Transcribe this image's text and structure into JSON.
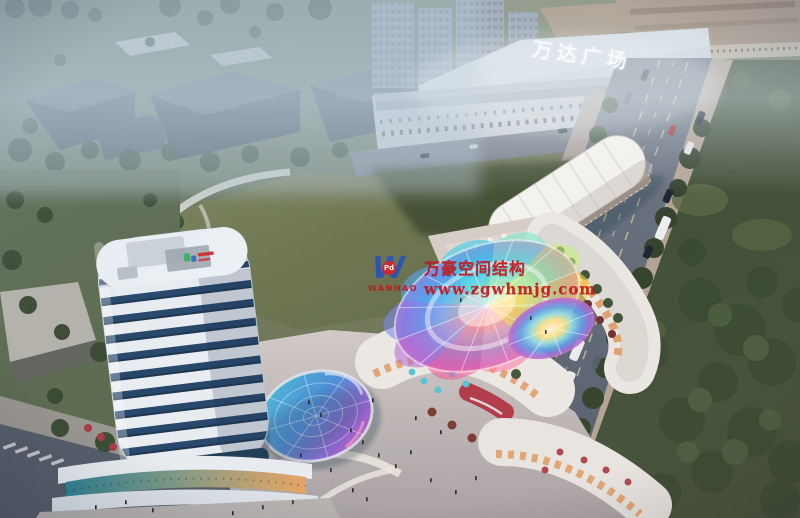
{
  "scene": {
    "mall_sign": "万达广场"
  },
  "watermark": {
    "logo_letter": "W",
    "logo_badge": "Pd",
    "logo_name": "WANHAO",
    "line1": "万豪空间结构",
    "line2": "www.zgwhmjg.com",
    "text_color": "#c8161c",
    "logo_blue": "#2b53b5"
  },
  "palette": {
    "haze": "#d6e2ea",
    "field_green": "#6f7852",
    "road_gray": "#636c78",
    "tower_glass": "#27476b",
    "tower_band": "#e9edf1",
    "accent_red": "#b23a4a",
    "canopy_colors": [
      "#ffd84d",
      "#ffb347",
      "#ff7fae",
      "#f05fa0",
      "#b96fd6",
      "#7f86e8",
      "#4fa9ef",
      "#39cfe8",
      "#7fe8cf",
      "#c9ef7f"
    ]
  }
}
